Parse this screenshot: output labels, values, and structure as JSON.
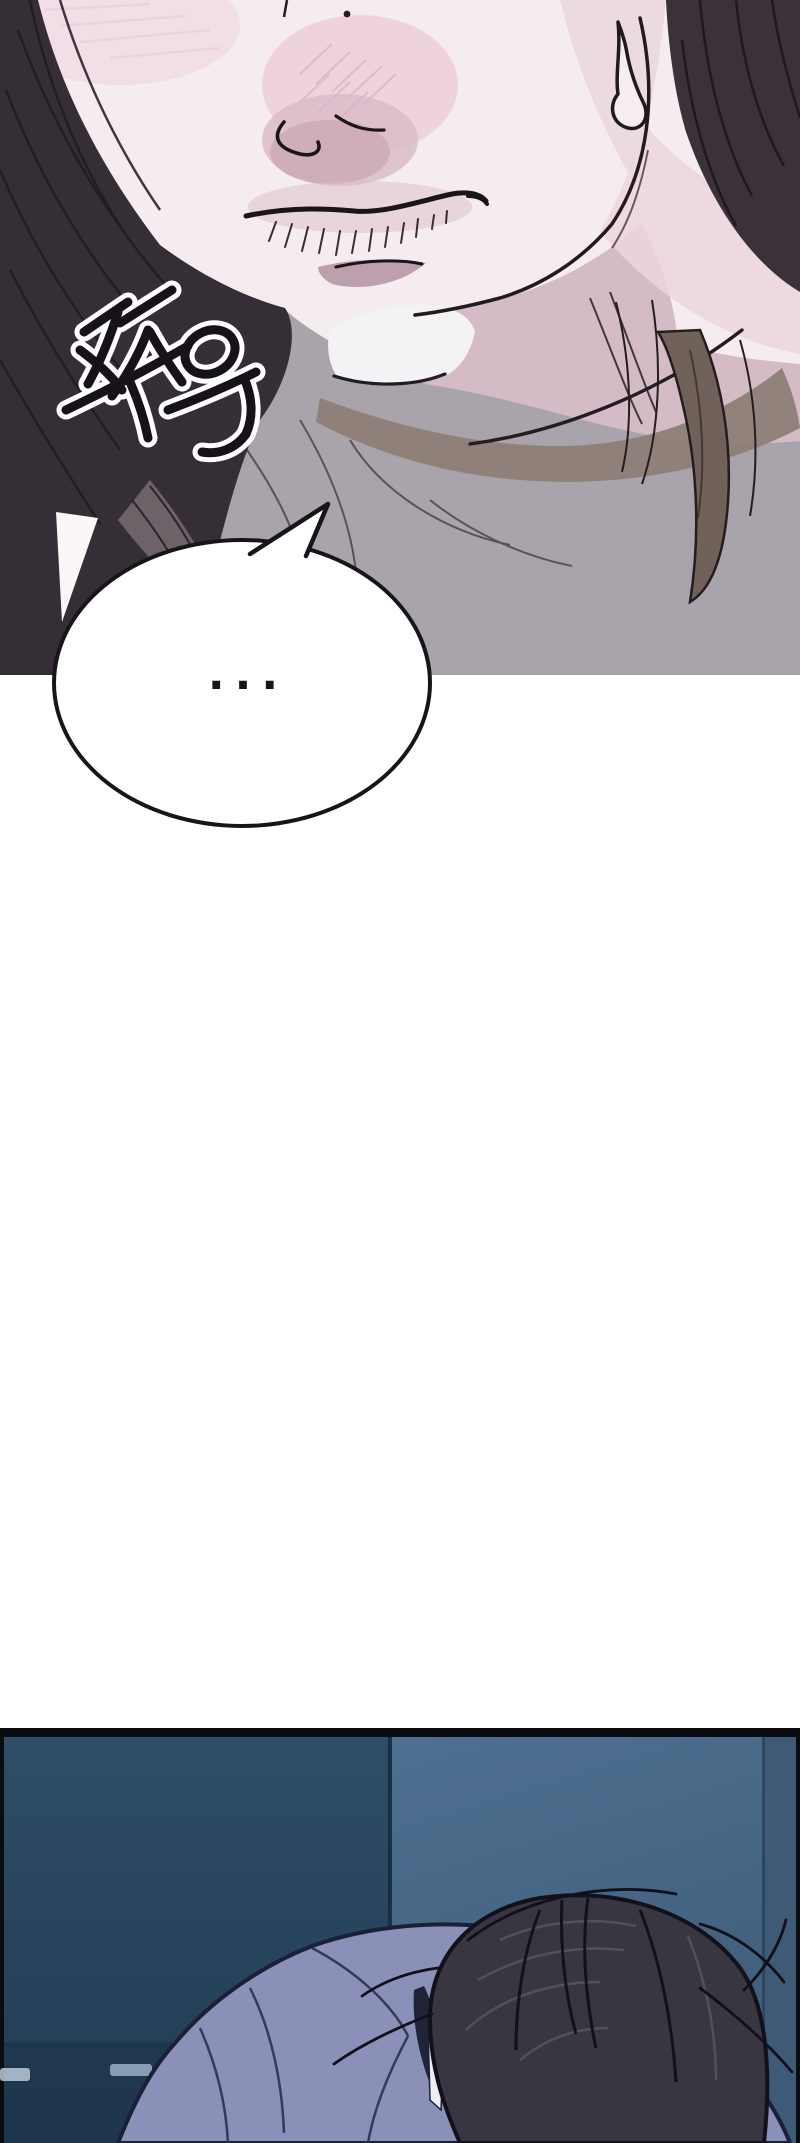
{
  "page": {
    "kind": "webtoon comic strip segment",
    "background": "#ffffff",
    "panel_count": 2
  },
  "panels": [
    {
      "name": "closeup-face",
      "alt": "Extreme close-up of a pale character's nose and pressed lips, blush on the nose, long dark hair framing both sides, a sweat drop sliding past the jaw, grey shirt with white collar below",
      "sfx": {
        "text": "쭈욱",
        "style": "black brush lettering with white outline, drawn diagonally"
      },
      "speech_bubble": {
        "text": "...",
        "shape": "ellipse",
        "fill": "#ffffff",
        "border": "#17141a",
        "tail": "top-right"
      },
      "palette": {
        "skin": "#f4ecef",
        "blush": "#eccfdb",
        "nose_shadow": "#c9a7b5",
        "hair_dark": "#362e36",
        "hair_brown": "#70615a",
        "shirt_grey": "#a9a3ab",
        "collar_white": "#f3f2f4",
        "collar_shadow_brown": "#8d8077",
        "neck_shadow": "#d2b6c1",
        "ink_line": "#1c151b"
      }
    },
    {
      "name": "dark-room",
      "alt": "Dim blue room at night; a person in a periwinkle shirt slumped forward with dark messy hair hiding the face, white earbud wire visible",
      "palette": {
        "frame": "#0a0c10",
        "wall_left": "#2e4c67",
        "wall_left_lower": "#1c3349",
        "wall_right": "#4d6e8e",
        "wall_corner": "#152a3e",
        "right_band": "#3e5a76",
        "shirt": "#8a90b7",
        "shirt_fold": "#2b3152",
        "hair": "#393641",
        "hair_highlight": "#555160",
        "earbud_white": "#eceef2",
        "light_dashes": "#93a9c0"
      }
    }
  ]
}
